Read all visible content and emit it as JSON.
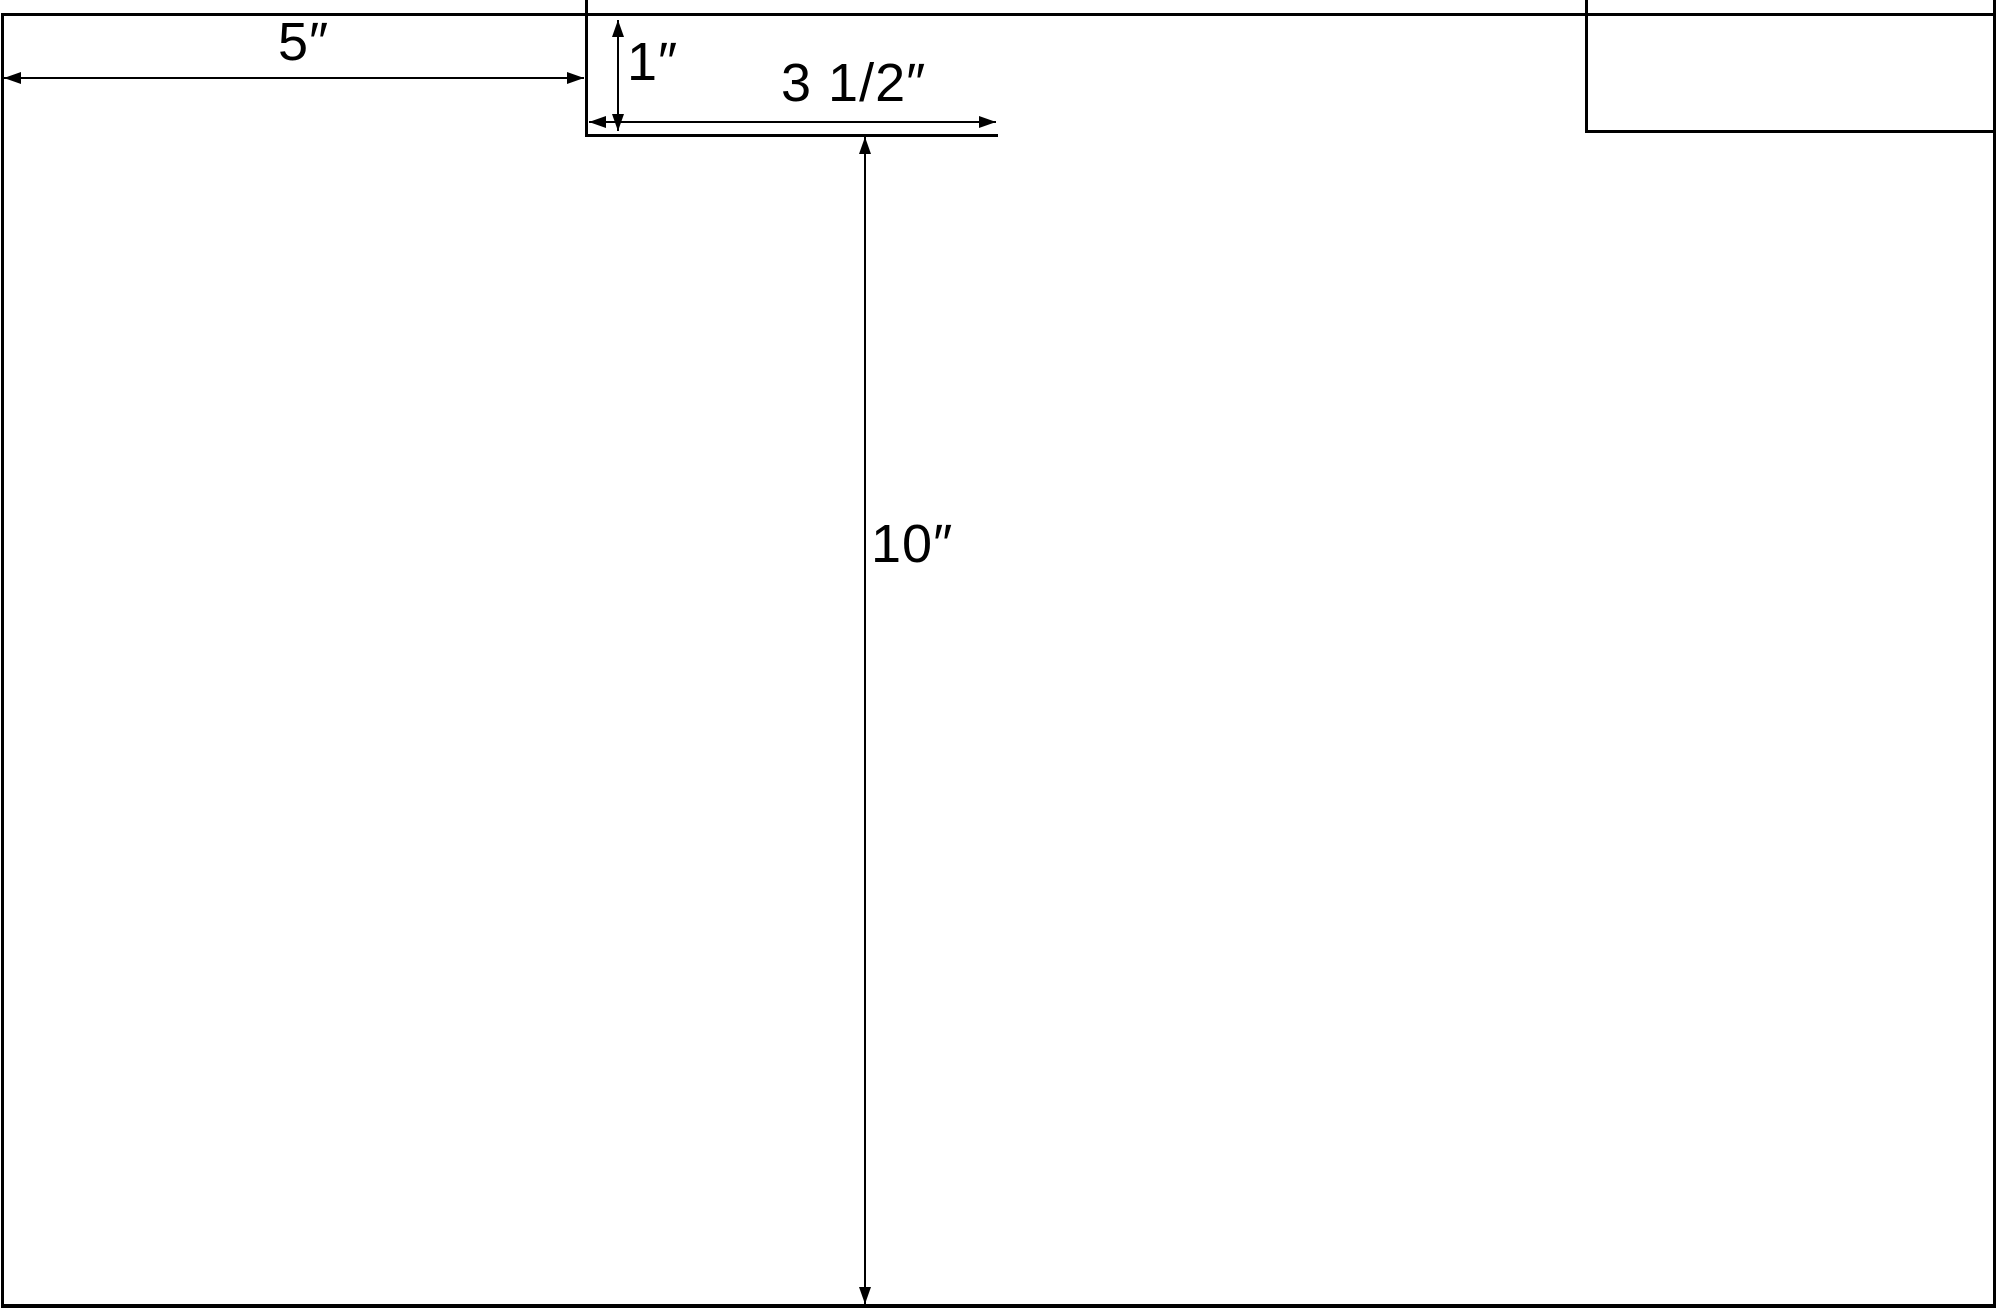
{
  "diagram": {
    "type": "dimensioned-technical-drawing",
    "unit": "inches",
    "colors": {
      "line": "#000000",
      "background": "#ffffff"
    },
    "dimensions": [
      {
        "id": "left-section-width",
        "label": "5″",
        "value_in": 5,
        "orientation": "horizontal"
      },
      {
        "id": "tab-height",
        "label": "1″",
        "value_in": 1,
        "orientation": "vertical"
      },
      {
        "id": "tab-width",
        "label": "3 1/2″",
        "value_in": 3.5,
        "orientation": "horizontal"
      },
      {
        "id": "body-height",
        "label": "10″",
        "value_in": 10,
        "orientation": "vertical"
      }
    ]
  }
}
